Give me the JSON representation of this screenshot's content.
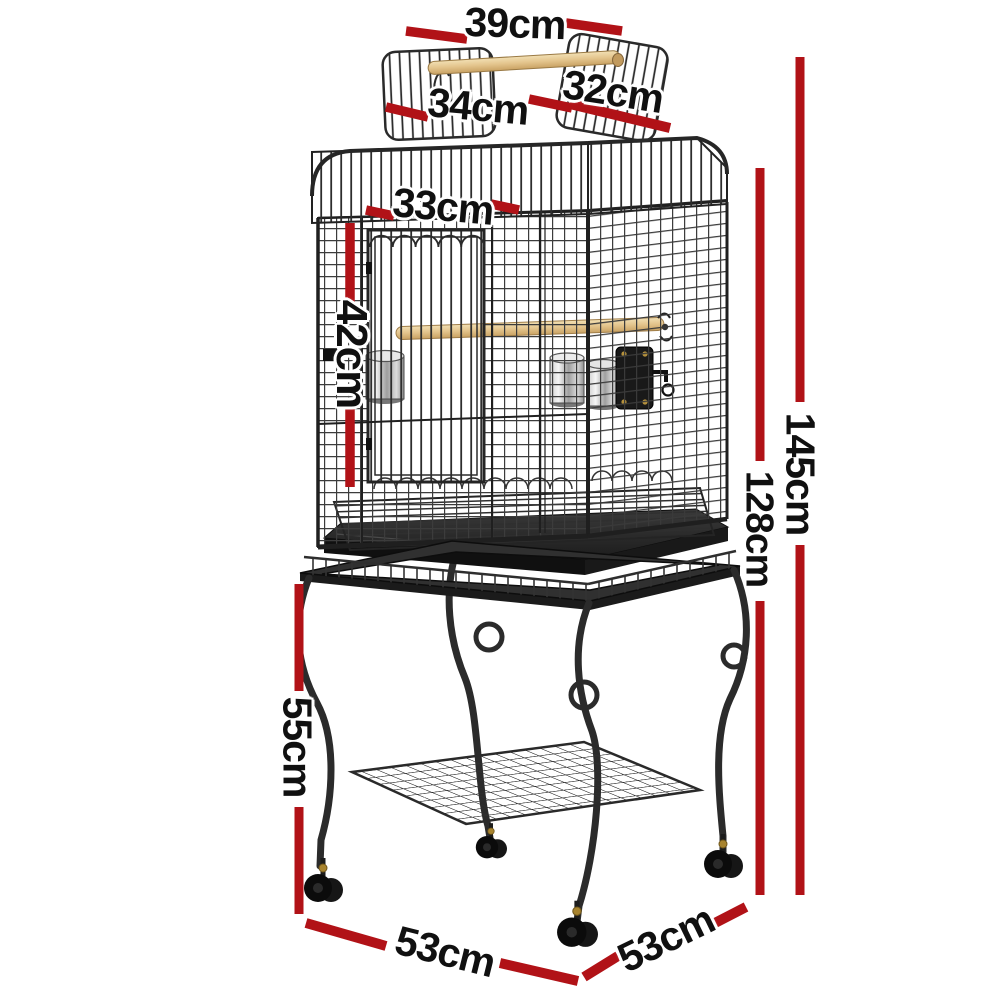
{
  "page": {
    "background_color": "#ffffff"
  },
  "diagram": {
    "accent_color": "#b11217",
    "ink_color": "#101010",
    "unit": "cm",
    "measurements": [
      {
        "id": "top-perch-width",
        "label": "39cm"
      },
      {
        "id": "left-roof-door",
        "label": "34cm"
      },
      {
        "id": "right-roof-door",
        "label": "32cm"
      },
      {
        "id": "front-door-width",
        "label": "33cm"
      },
      {
        "id": "front-door-height",
        "label": "42cm"
      },
      {
        "id": "total-height",
        "label": "145cm"
      },
      {
        "id": "cage-height",
        "label": "128cm"
      },
      {
        "id": "stand-height",
        "label": "55cm"
      },
      {
        "id": "base-width",
        "label": "53cm"
      },
      {
        "id": "base-depth",
        "label": "53cm"
      }
    ]
  }
}
